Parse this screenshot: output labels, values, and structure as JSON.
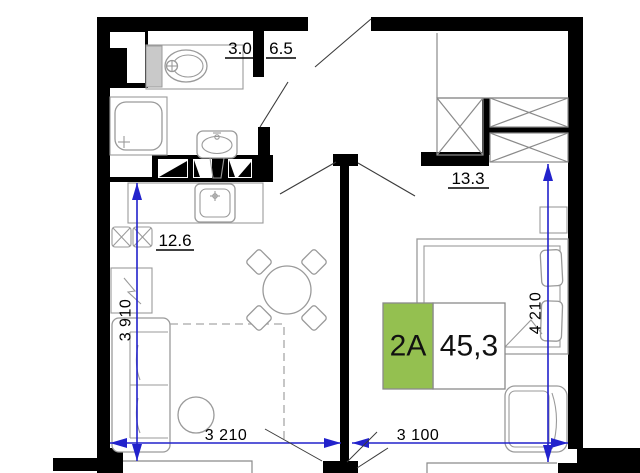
{
  "rooms": {
    "bathroom": "3.0",
    "hallway": "6.5",
    "bedroom": "13.3",
    "kitchen_living": "12.6"
  },
  "dimensions": {
    "vertical_left": "3 910",
    "vertical_right": "4 210",
    "horizontal_left": "3 210",
    "horizontal_right": "3 100"
  },
  "badge": {
    "unit_type": "2A",
    "area": "45,3"
  },
  "colors": {
    "dimension_blue": "#2222cc",
    "badge_green": "#94c050",
    "wall_black": "#000000",
    "furniture_gray": "#9a9a9a"
  }
}
